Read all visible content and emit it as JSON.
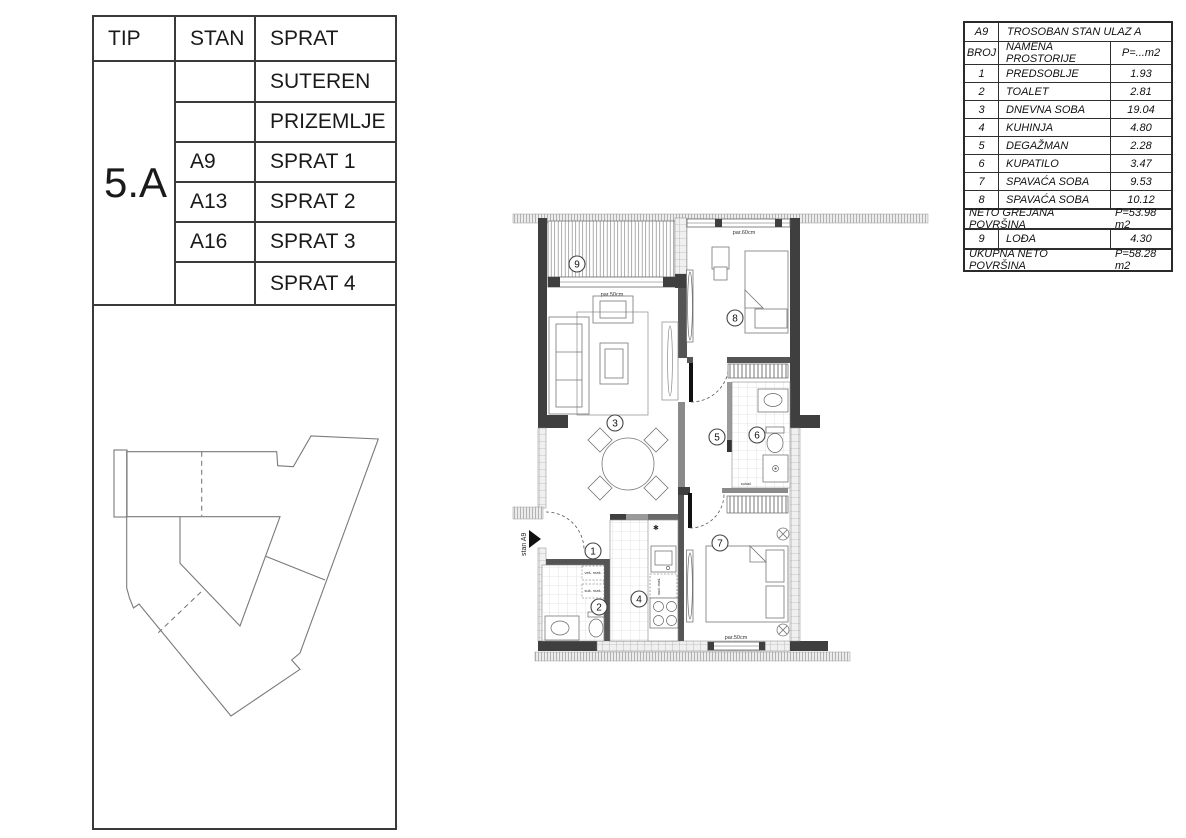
{
  "left_table": {
    "headers": {
      "tip": "TIP",
      "stan": "STAN",
      "sprat": "SPRAT"
    },
    "tip_value": "5.A",
    "rows": [
      {
        "stan": "",
        "sprat": "SUTEREN"
      },
      {
        "stan": "",
        "sprat": "PRIZEMLJE"
      },
      {
        "stan": "A9",
        "sprat": "SPRAT 1"
      },
      {
        "stan": "A13",
        "sprat": "SPRAT 2"
      },
      {
        "stan": "A16",
        "sprat": "SPRAT 3"
      },
      {
        "stan": "",
        "sprat": "SPRAT 4"
      }
    ]
  },
  "area_table": {
    "unit_id": "A9",
    "unit_title": "TROSOBAN STAN ULAZ A",
    "col_headers": {
      "broj": "BROJ",
      "namena": "NAMENA PROSTORIJE",
      "p": "P=...m2"
    },
    "rooms": [
      {
        "broj": "1",
        "name": "PREDSOBLJE",
        "area": "1.93"
      },
      {
        "broj": "2",
        "name": "TOALET",
        "area": "2.81"
      },
      {
        "broj": "3",
        "name": "DNEVNA SOBA",
        "area": "19.04"
      },
      {
        "broj": "4",
        "name": "KUHINJA",
        "area": "4.80"
      },
      {
        "broj": "5",
        "name": "DEGAŽMAN",
        "area": "2.28"
      },
      {
        "broj": "6",
        "name": "KUPATILO",
        "area": "3.47"
      },
      {
        "broj": "7",
        "name": "SPAVAĆA SOBA",
        "area": "9.53"
      },
      {
        "broj": "8",
        "name": "SPAVAĆA SOBA",
        "area": "10.12"
      }
    ],
    "neto": {
      "label": "NETO GREJANA POVRŠINA",
      "value": "P=53.98 m2"
    },
    "lodja": {
      "broj": "9",
      "name": "LOĐA",
      "area": "4.30"
    },
    "ukupna": {
      "label": "UKUPNA NETO POVRŠINA",
      "value": "P=58.28 m2"
    }
  },
  "plan": {
    "numbers": [
      "1",
      "2",
      "3",
      "4",
      "5",
      "6",
      "7",
      "8",
      "9"
    ],
    "entrance_label": "stan A9",
    "loggia_window_label": "par.50cm",
    "bedroom8_window_label": "par.60cm",
    "bedroom7_window_label": "par.50cm",
    "appliances": {
      "washer": "veš. maš.",
      "dryer": "suš. maš.",
      "dishwasher": "sud. maš.",
      "dryer_small": "sušač"
    },
    "star": "✱"
  }
}
